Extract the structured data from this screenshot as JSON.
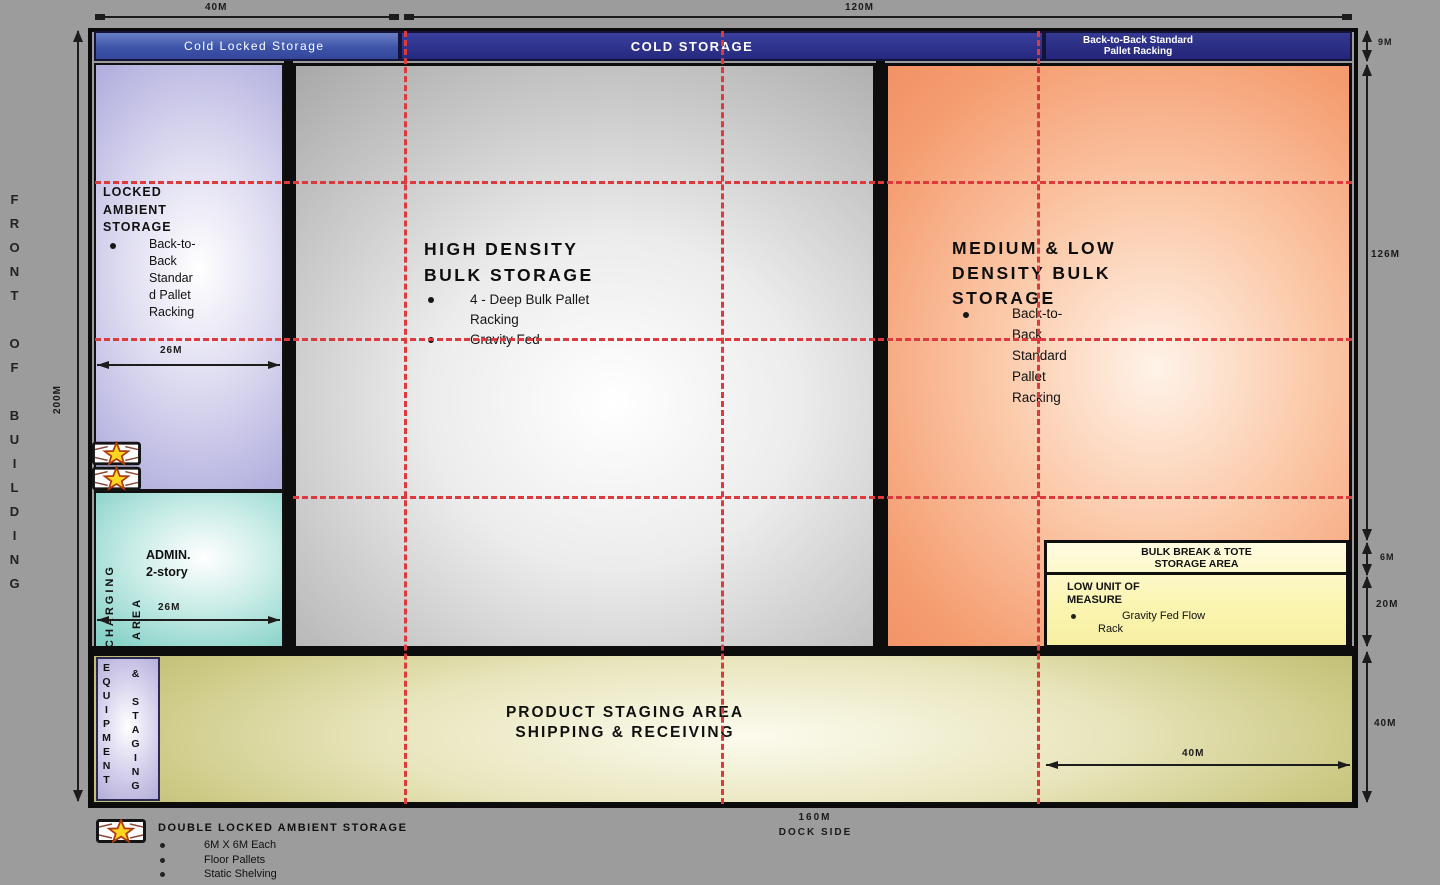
{
  "colors": {
    "background": "#9c9c9c",
    "navy_bar": "#2b2e8e",
    "blue_bar": "#3d54a8",
    "locked_ambient_purple": "#aca9dd",
    "admin_teal": "#79ccc2",
    "bulk_gray": "#b3b3b3",
    "medium_low_orange": "#f2926a",
    "staging_olive": "#c3c073",
    "bulk_break_yellow": "#fbf5b2",
    "equipment_lavender": "#b2abd6",
    "grid_dashed_red": "#dc3a3c",
    "star_yellow": "#ffd61f"
  },
  "top": {
    "dim_40": "40M",
    "dim_120": "120M",
    "bar_cold_locked": "Cold Locked Storage",
    "bar_cold_storage": "COLD STORAGE",
    "bar_b2b_line1": "Back-to-Back Standard",
    "bar_b2b_line2": "Pallet Racking"
  },
  "left_side": {
    "front_of_building": "FRONT OF BUILDING",
    "dim_200": "200M"
  },
  "right_dims": {
    "d9": "9M",
    "d126": "126M",
    "d6": "6M",
    "d20": "20M",
    "d40": "40M"
  },
  "locked_ambient": {
    "title_line1": "LOCKED",
    "title_line2": "AMBIENT",
    "title_line3": "STORAGE",
    "bullet_lines": [
      "Back-to-",
      "Back",
      "Standar",
      "d Pallet",
      "Racking"
    ],
    "dim_26": "26M"
  },
  "admin": {
    "line1": "ADMIN.",
    "line2": "2-story",
    "charging": "CHARGING",
    "area": "AREA",
    "dim_26": "26M"
  },
  "high_density": {
    "title_line1": "HIGH DENSITY",
    "title_line2": "BULK STORAGE",
    "bullet1_line1": "4 - Deep Bulk Pallet",
    "bullet1_line2": "Racking",
    "bullet2": "Gravity Fed"
  },
  "medium_low": {
    "title_line1": "MEDIUM & LOW",
    "title_line2": "DENSITY BULK",
    "title_line3": "STORAGE",
    "bullet_lines": [
      "Back-to-",
      "Back",
      "Standard",
      "Pallet",
      "Racking"
    ]
  },
  "bulk_break": {
    "header_line1": "BULK BREAK & TOTE",
    "header_line2": "STORAGE AREA",
    "body_line1": "LOW UNIT OF",
    "body_line2": "MEASURE",
    "bullet_line1": "Gravity Fed Flow",
    "bullet_line2": "Rack"
  },
  "staging": {
    "line1": "PRODUCT STAGING AREA",
    "line2": "SHIPPING & RECEIVING",
    "equipment": "EQUIPMENT",
    "and_staging": "& STAGING",
    "dim_40": "40M"
  },
  "bottom": {
    "dim_160": "160M",
    "dock_side": "DOCK SIDE"
  },
  "legend": {
    "title": "DOUBLE LOCKED AMBIENT STORAGE",
    "items": [
      "6M X 6M Each",
      "Floor Pallets",
      "Static Shelving"
    ]
  }
}
